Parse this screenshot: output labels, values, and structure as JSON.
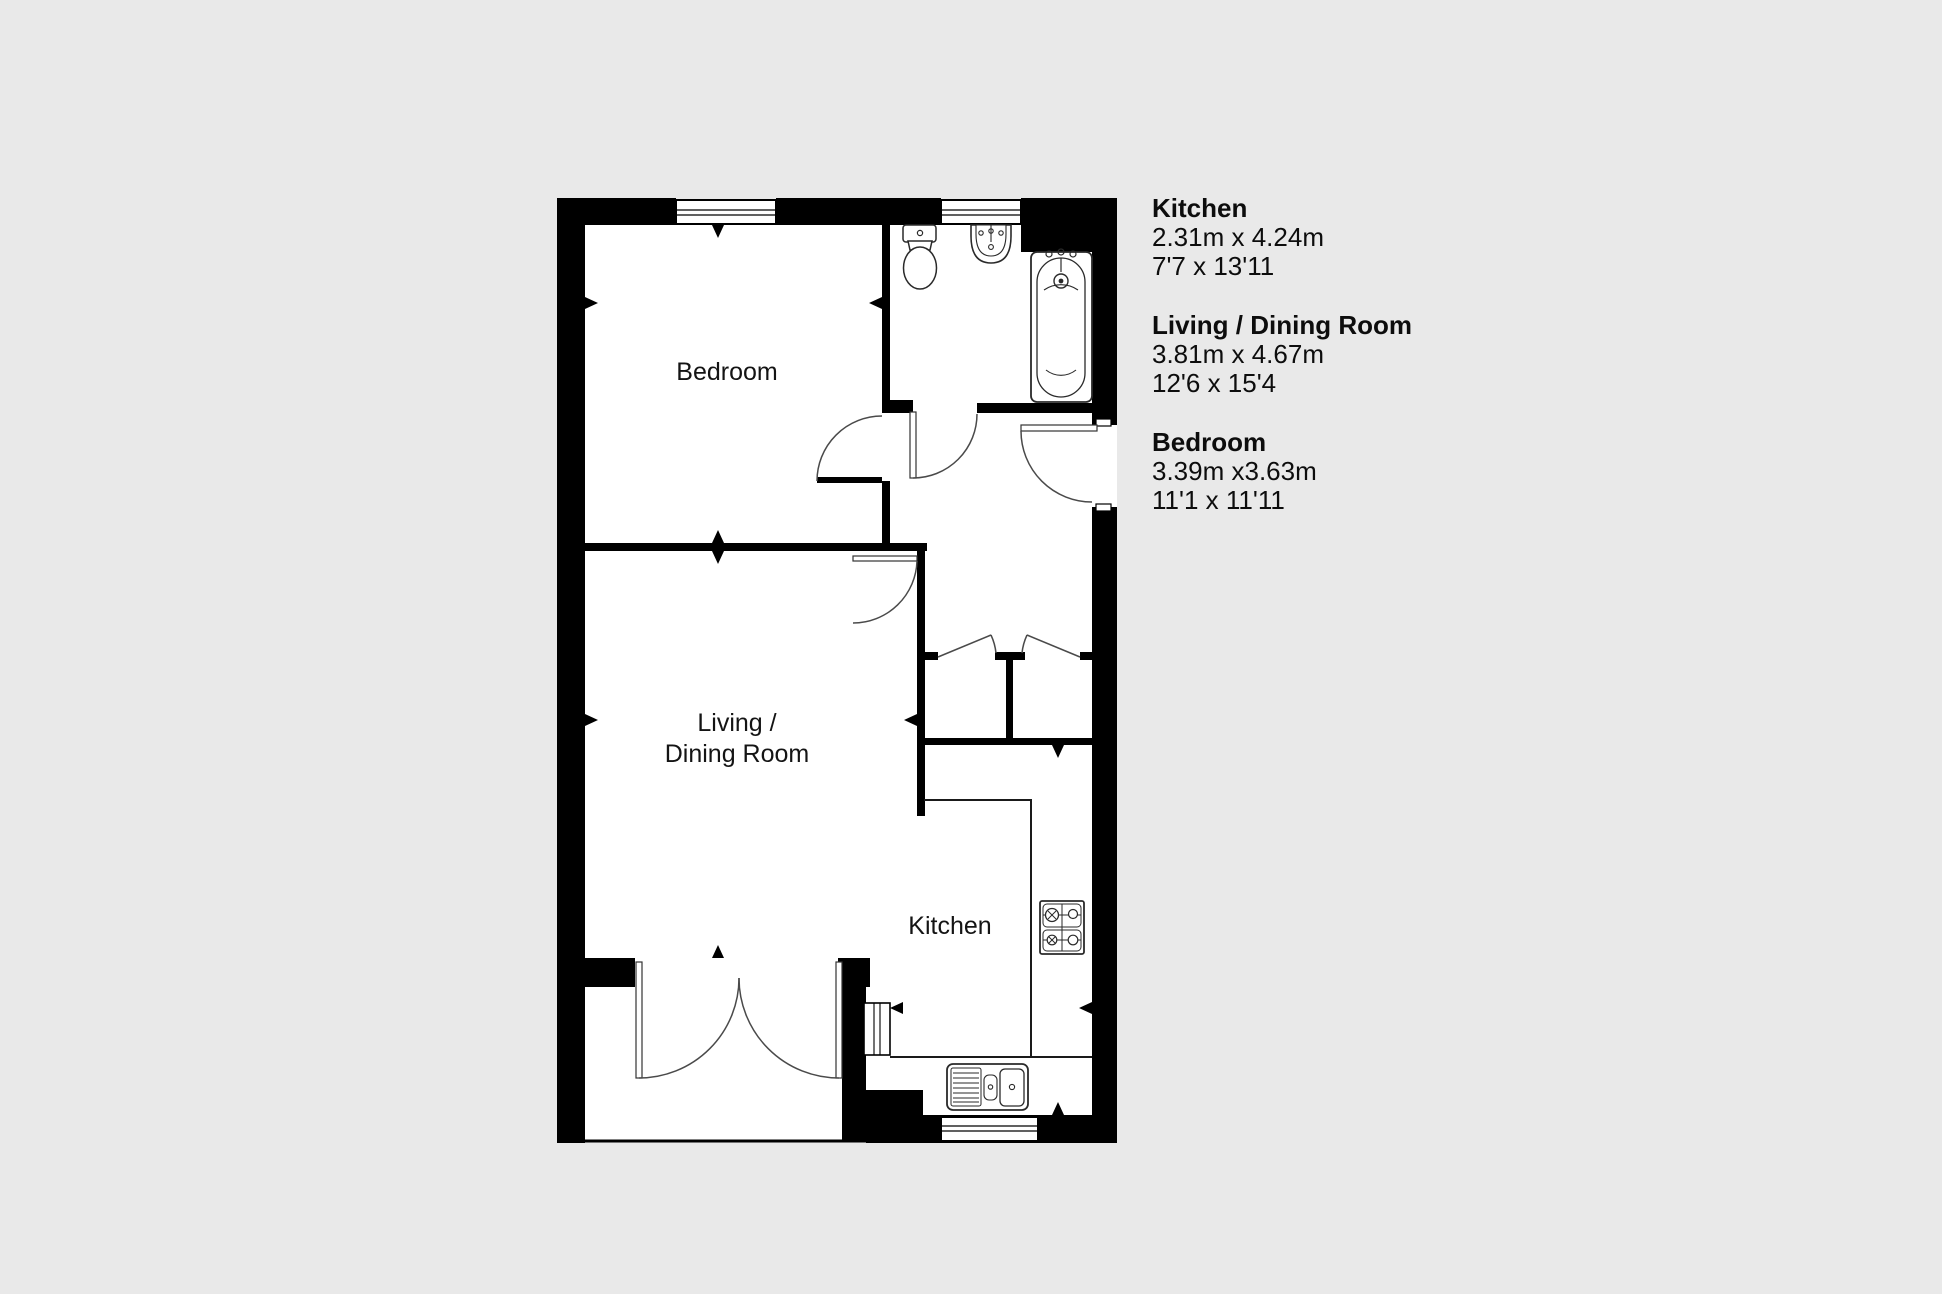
{
  "canvas": {
    "background_color": "#e9e9e9",
    "wall_color": "#000000",
    "floor_color": "#ffffff",
    "door_arc_color": "#4a4a4a"
  },
  "plan": {
    "labels": {
      "bedroom": "Bedroom",
      "living_line1": "Living /",
      "living_line2": "Dining Room",
      "kitchen": "Kitchen"
    },
    "fixtures": [
      "toilet",
      "basin",
      "bathtub",
      "hob",
      "kitchen-sink",
      "worktop",
      "wardrobe-closets",
      "french-doors"
    ]
  },
  "legend": {
    "rooms": [
      {
        "name": "Kitchen",
        "metric": "2.31m x 4.24m",
        "imperial": "7'7 x 13'11"
      },
      {
        "name": "Living / Dining Room",
        "metric": "3.81m x 4.67m",
        "imperial": "12'6 x 15'4"
      },
      {
        "name": "Bedroom",
        "metric": "3.39m x3.63m",
        "imperial": "11'1 x 11'11"
      }
    ]
  }
}
